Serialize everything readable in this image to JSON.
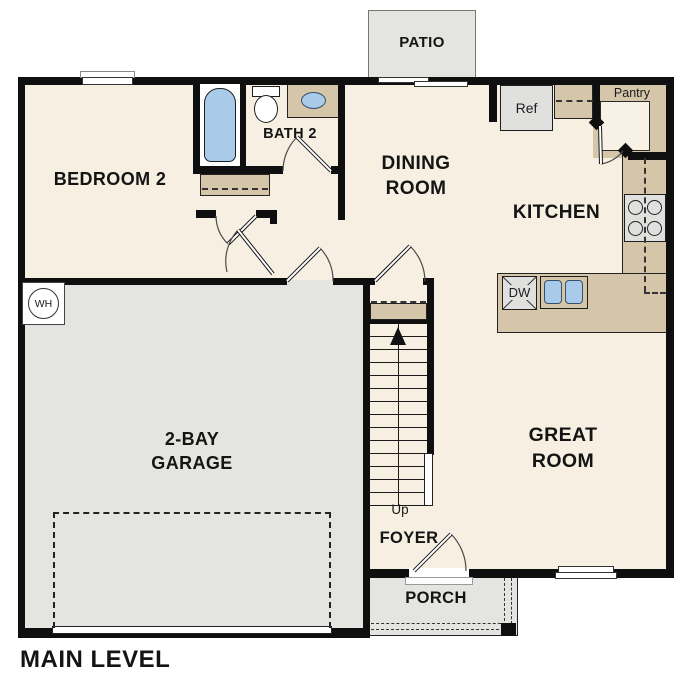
{
  "plan": {
    "title": "MAIN LEVEL",
    "rooms": {
      "bedroom2": "BEDROOM 2",
      "bath2": "BATH 2",
      "dining1": "DINING",
      "dining2": "ROOM",
      "kitchen": "KITCHEN",
      "great1": "GREAT",
      "great2": "ROOM",
      "garage1": "2-BAY",
      "garage2": "GARAGE",
      "foyer": "FOYER",
      "porch": "PORCH",
      "patio": "PATIO",
      "pantry": "Pantry"
    },
    "labels": {
      "ref": "Ref",
      "dw": "DW",
      "wh": "WH",
      "up": "Up"
    },
    "colors": {
      "wall": "#0F0F0F",
      "floor_cream": "#F7EFE2",
      "counter_tan": "#D5C6AA",
      "garage_gray": "#E4E4E1",
      "fixture_blue": "#A9CAE9",
      "appliance_gray": "#E0E1DF"
    }
  }
}
